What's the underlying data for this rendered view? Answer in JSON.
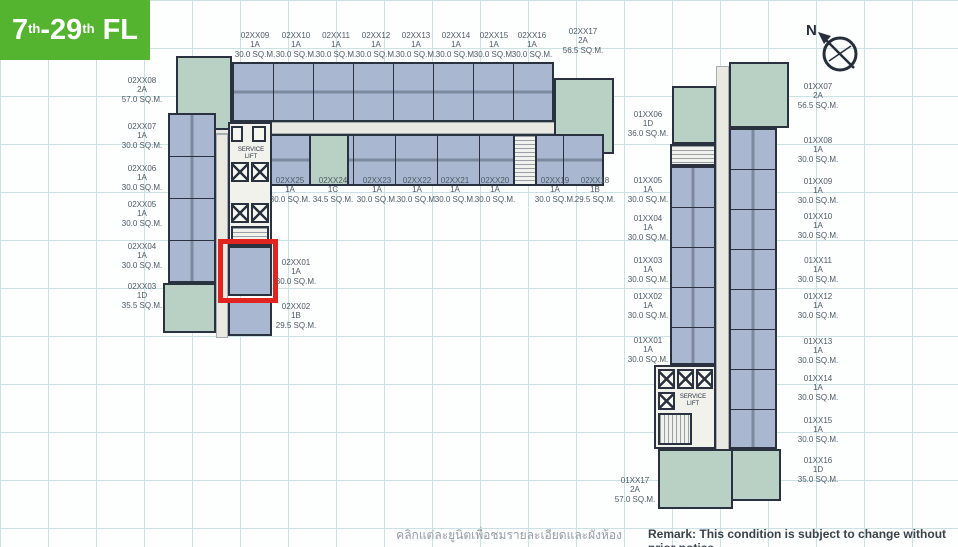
{
  "compass": {
    "north_label": "N"
  },
  "floor_badge": {
    "n1": "7",
    "s1": "th",
    "dash": "-",
    "n2": "29",
    "s2": "th",
    "fl": "FL"
  },
  "footer": {
    "thai_note": "คลิกแต่ละยูนิตเพื่อชมรายละเอียดและผังห้อง",
    "remark": "Remark: This condition is subject to change without prior notice"
  },
  "core_labels": {
    "service_lift_left": "SERVICE LIFT",
    "service_lift_right": "SERVICE LIFT"
  },
  "colors": {
    "unit_blue": "#a9b8d0",
    "unit_green": "#b9d0c4",
    "wall": "#2a3240",
    "highlight_red": "#e02420",
    "badge_green": "#54b32f",
    "grid_line": "#cbe1e6"
  },
  "units": {
    "top_row": [
      {
        "id": "02XX09",
        "type": "1A",
        "area": "30.0 SQ.M."
      },
      {
        "id": "02XX10",
        "type": "1A",
        "area": "30.0 SQ.M."
      },
      {
        "id": "02XX11",
        "type": "1A",
        "area": "30.0 SQ.M."
      },
      {
        "id": "02XX12",
        "type": "1A",
        "area": "30.0 SQ.M."
      },
      {
        "id": "02XX13",
        "type": "1A",
        "area": "30.0 SQ.M."
      },
      {
        "id": "02XX14",
        "type": "1A",
        "area": "30.0 SQ.M."
      },
      {
        "id": "02XX15",
        "type": "1A",
        "area": "30.0 SQ.M."
      },
      {
        "id": "02XX16",
        "type": "1A",
        "area": "30.0 SQ.M."
      },
      {
        "id": "02XX17",
        "type": "2A",
        "area": "56.5 SQ.M."
      }
    ],
    "left_col": [
      {
        "id": "02XX08",
        "type": "2A",
        "area": "57.0 SQ.M."
      },
      {
        "id": "02XX07",
        "type": "1A",
        "area": "30.0 SQ.M."
      },
      {
        "id": "02XX06",
        "type": "1A",
        "area": "30.0 SQ.M."
      },
      {
        "id": "02XX05",
        "type": "1A",
        "area": "30.0 SQ.M."
      },
      {
        "id": "02XX04",
        "type": "1A",
        "area": "30.0 SQ.M."
      },
      {
        "id": "02XX03",
        "type": "1D",
        "area": "35.5 SQ.M."
      }
    ],
    "mid_row": [
      {
        "id": "02XX25",
        "type": "1A",
        "area": "30.0 SQ.M."
      },
      {
        "id": "02XX24",
        "type": "1C",
        "area": "34.5 SQ.M."
      },
      {
        "id": "02XX23",
        "type": "1A",
        "area": "30.0 SQ.M."
      },
      {
        "id": "02XX22",
        "type": "1A",
        "area": "30.0 SQ.M."
      },
      {
        "id": "02XX21",
        "type": "1A",
        "area": "30.0 SQ.M."
      },
      {
        "id": "02XX20",
        "type": "1A",
        "area": "30.0 SQ.M."
      },
      {
        "id": "02XX19",
        "type": "1A",
        "area": "30.0 SQ.M."
      },
      {
        "id": "02XX18",
        "type": "1B",
        "area": "29.5 SQ.M."
      }
    ],
    "inner": [
      {
        "id": "02XX01",
        "type": "1A",
        "area": "30.0 SQ.M.",
        "highlighted": "true"
      },
      {
        "id": "02XX02",
        "type": "1B",
        "area": "29.5 SQ.M."
      }
    ],
    "right_wing_west": [
      {
        "id": "01XX06",
        "type": "1D",
        "area": "36.0 SQ.M."
      },
      {
        "id": "01XX05",
        "type": "1A",
        "area": "30.0 SQ.M."
      },
      {
        "id": "01XX04",
        "type": "1A",
        "area": "30.0 SQ.M."
      },
      {
        "id": "01XX03",
        "type": "1A",
        "area": "30.0 SQ.M."
      },
      {
        "id": "01XX02",
        "type": "1A",
        "area": "30.0 SQ.M."
      },
      {
        "id": "01XX01",
        "type": "1A",
        "area": "30.0 SQ.M."
      },
      {
        "id": "01XX17",
        "type": "2A",
        "area": "57.0 SQ.M."
      }
    ],
    "right_wing_east": [
      {
        "id": "01XX07",
        "type": "2A",
        "area": "56.5 SQ.M."
      },
      {
        "id": "01XX08",
        "type": "1A",
        "area": "30.0 SQ.M."
      },
      {
        "id": "01XX09",
        "type": "1A",
        "area": "30.0 SQ.M."
      },
      {
        "id": "01XX10",
        "type": "1A",
        "area": "30.0 SQ.M."
      },
      {
        "id": "01XX11",
        "type": "1A",
        "area": "30.0 SQ.M."
      },
      {
        "id": "01XX12",
        "type": "1A",
        "area": "30.0 SQ.M."
      },
      {
        "id": "01XX13",
        "type": "1A",
        "area": "30.0 SQ.M."
      },
      {
        "id": "01XX14",
        "type": "1A",
        "area": "30.0 SQ.M."
      },
      {
        "id": "01XX15",
        "type": "1A",
        "area": "30.0 SQ.M."
      },
      {
        "id": "01XX16",
        "type": "1D",
        "area": "35.0 SQ.M."
      }
    ]
  }
}
